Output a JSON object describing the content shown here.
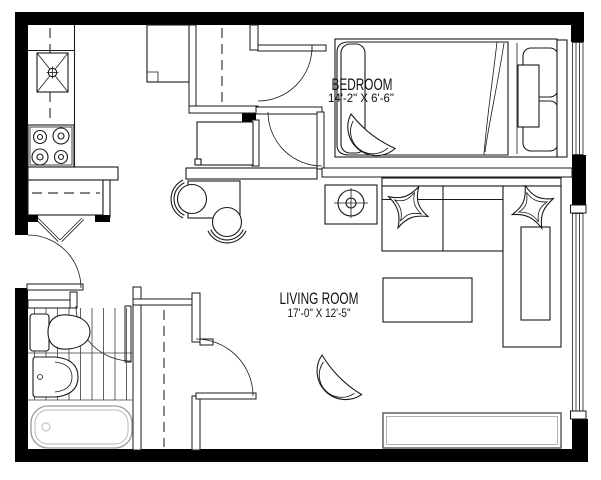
{
  "canvas": {
    "width": 601,
    "height": 480,
    "background": "#ffffff"
  },
  "colors": {
    "wall_fill": "#000000",
    "line": "#1a1a1a",
    "dashed_line": "#3a3a3a",
    "tub_line": "#9a9a9a",
    "background": "#ffffff"
  },
  "rooms": [
    {
      "id": "bedroom",
      "label": "BEDROOM",
      "dimensions": "14'-2\" X 6'-6\""
    },
    {
      "id": "living-room",
      "label": "LIVING ROOM",
      "dimensions": "17'-0\" X 12'-5\""
    }
  ],
  "symbols": [
    "kitchen-sink-icon",
    "stove-burners-icon",
    "refrigerator-icon",
    "counter-peninsula",
    "bifold-door-icon",
    "entry-door-swing",
    "closet-sliding-door",
    "washer-unit",
    "dining-table",
    "dining-chair",
    "bedroom-door-swing",
    "living-door-swing",
    "bed",
    "bed-pillow",
    "headboard",
    "fan-armchair",
    "side-table-with-lamp",
    "sectional-sofa",
    "throw-pillow-star",
    "coffee-table",
    "tv-console",
    "toilet",
    "bathroom-sink",
    "bathtub",
    "window-glazing"
  ]
}
